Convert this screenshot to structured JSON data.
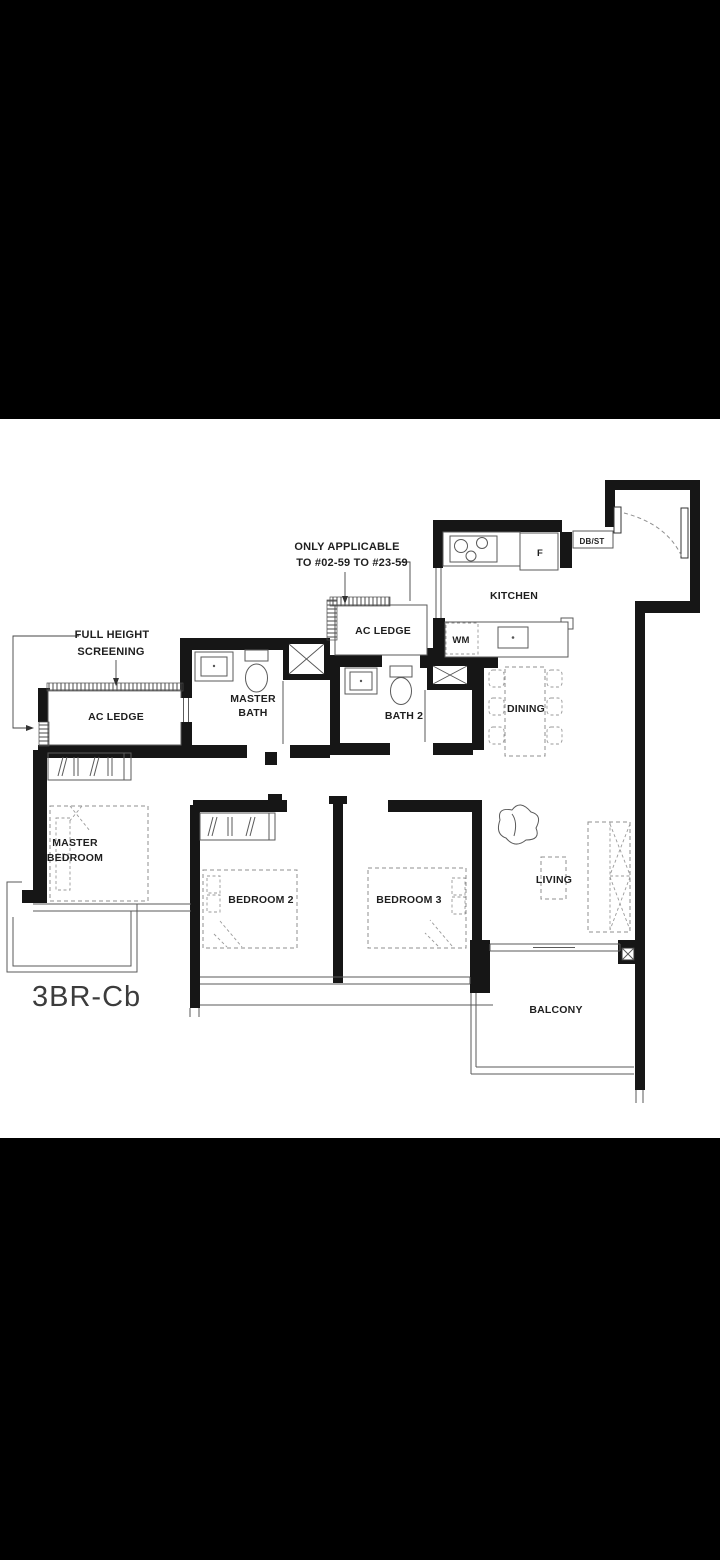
{
  "floorplan": {
    "title": "3BR-Cb",
    "unit_note_line1": "ONLY APPLICABLE",
    "unit_note_line2": "TO #02-59 TO #23-59",
    "screening_note_line1": "FULL HEIGHT",
    "screening_note_line2": "SCREENING",
    "rooms": {
      "kitchen": "KITCHEN",
      "dining": "DINING",
      "living": "LIVING",
      "balcony": "BALCONY",
      "master_bedroom_line1": "MASTER",
      "master_bedroom_line2": "BEDROOM",
      "bedroom_2": "BEDROOM 2",
      "bedroom_3": "BEDROOM 3",
      "master_bath_line1": "MASTER",
      "master_bath_line2": "BATH",
      "bath_2": "BATH 2",
      "ac_ledge_left": "AC LEDGE",
      "ac_ledge_kitchen": "AC LEDGE"
    },
    "fixtures": {
      "washing_machine": "WM",
      "fridge": "F",
      "db_store": "DB/ST"
    },
    "colors": {
      "wall": "#161616",
      "thin_line": "#5a5a5a",
      "furniture_dash": "#8f8f8f",
      "text": "#1f1f1f",
      "page_background": "#000000",
      "plan_background": "#ffffff"
    }
  }
}
